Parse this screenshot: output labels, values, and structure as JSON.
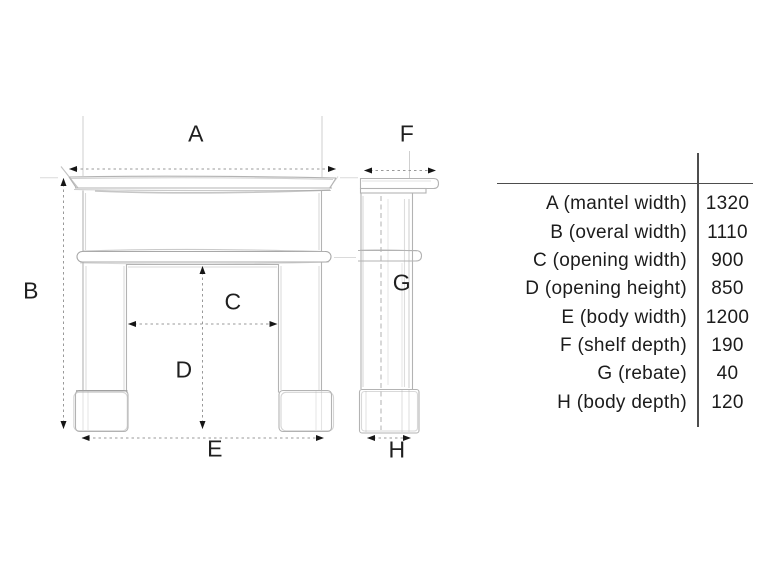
{
  "diagram": {
    "title": "fireplace-surround-dimension-drawing",
    "labels": {
      "a": "A",
      "b": "B",
      "c": "C",
      "d": "D",
      "e": "E",
      "f": "F",
      "g": "G",
      "h": "H"
    }
  },
  "table": {
    "rows": [
      {
        "label": "A (mantel width)",
        "value": "1320"
      },
      {
        "label": "B (overal width)",
        "value": "1110"
      },
      {
        "label": "C (opening width)",
        "value": "900"
      },
      {
        "label": "D (opening height)",
        "value": "850"
      },
      {
        "label": "E (body width)",
        "value": "1200"
      },
      {
        "label": "F (shelf depth)",
        "value": "190"
      },
      {
        "label": "G (rebate)",
        "value": "40"
      },
      {
        "label": "H (body depth)",
        "value": "120"
      }
    ]
  }
}
